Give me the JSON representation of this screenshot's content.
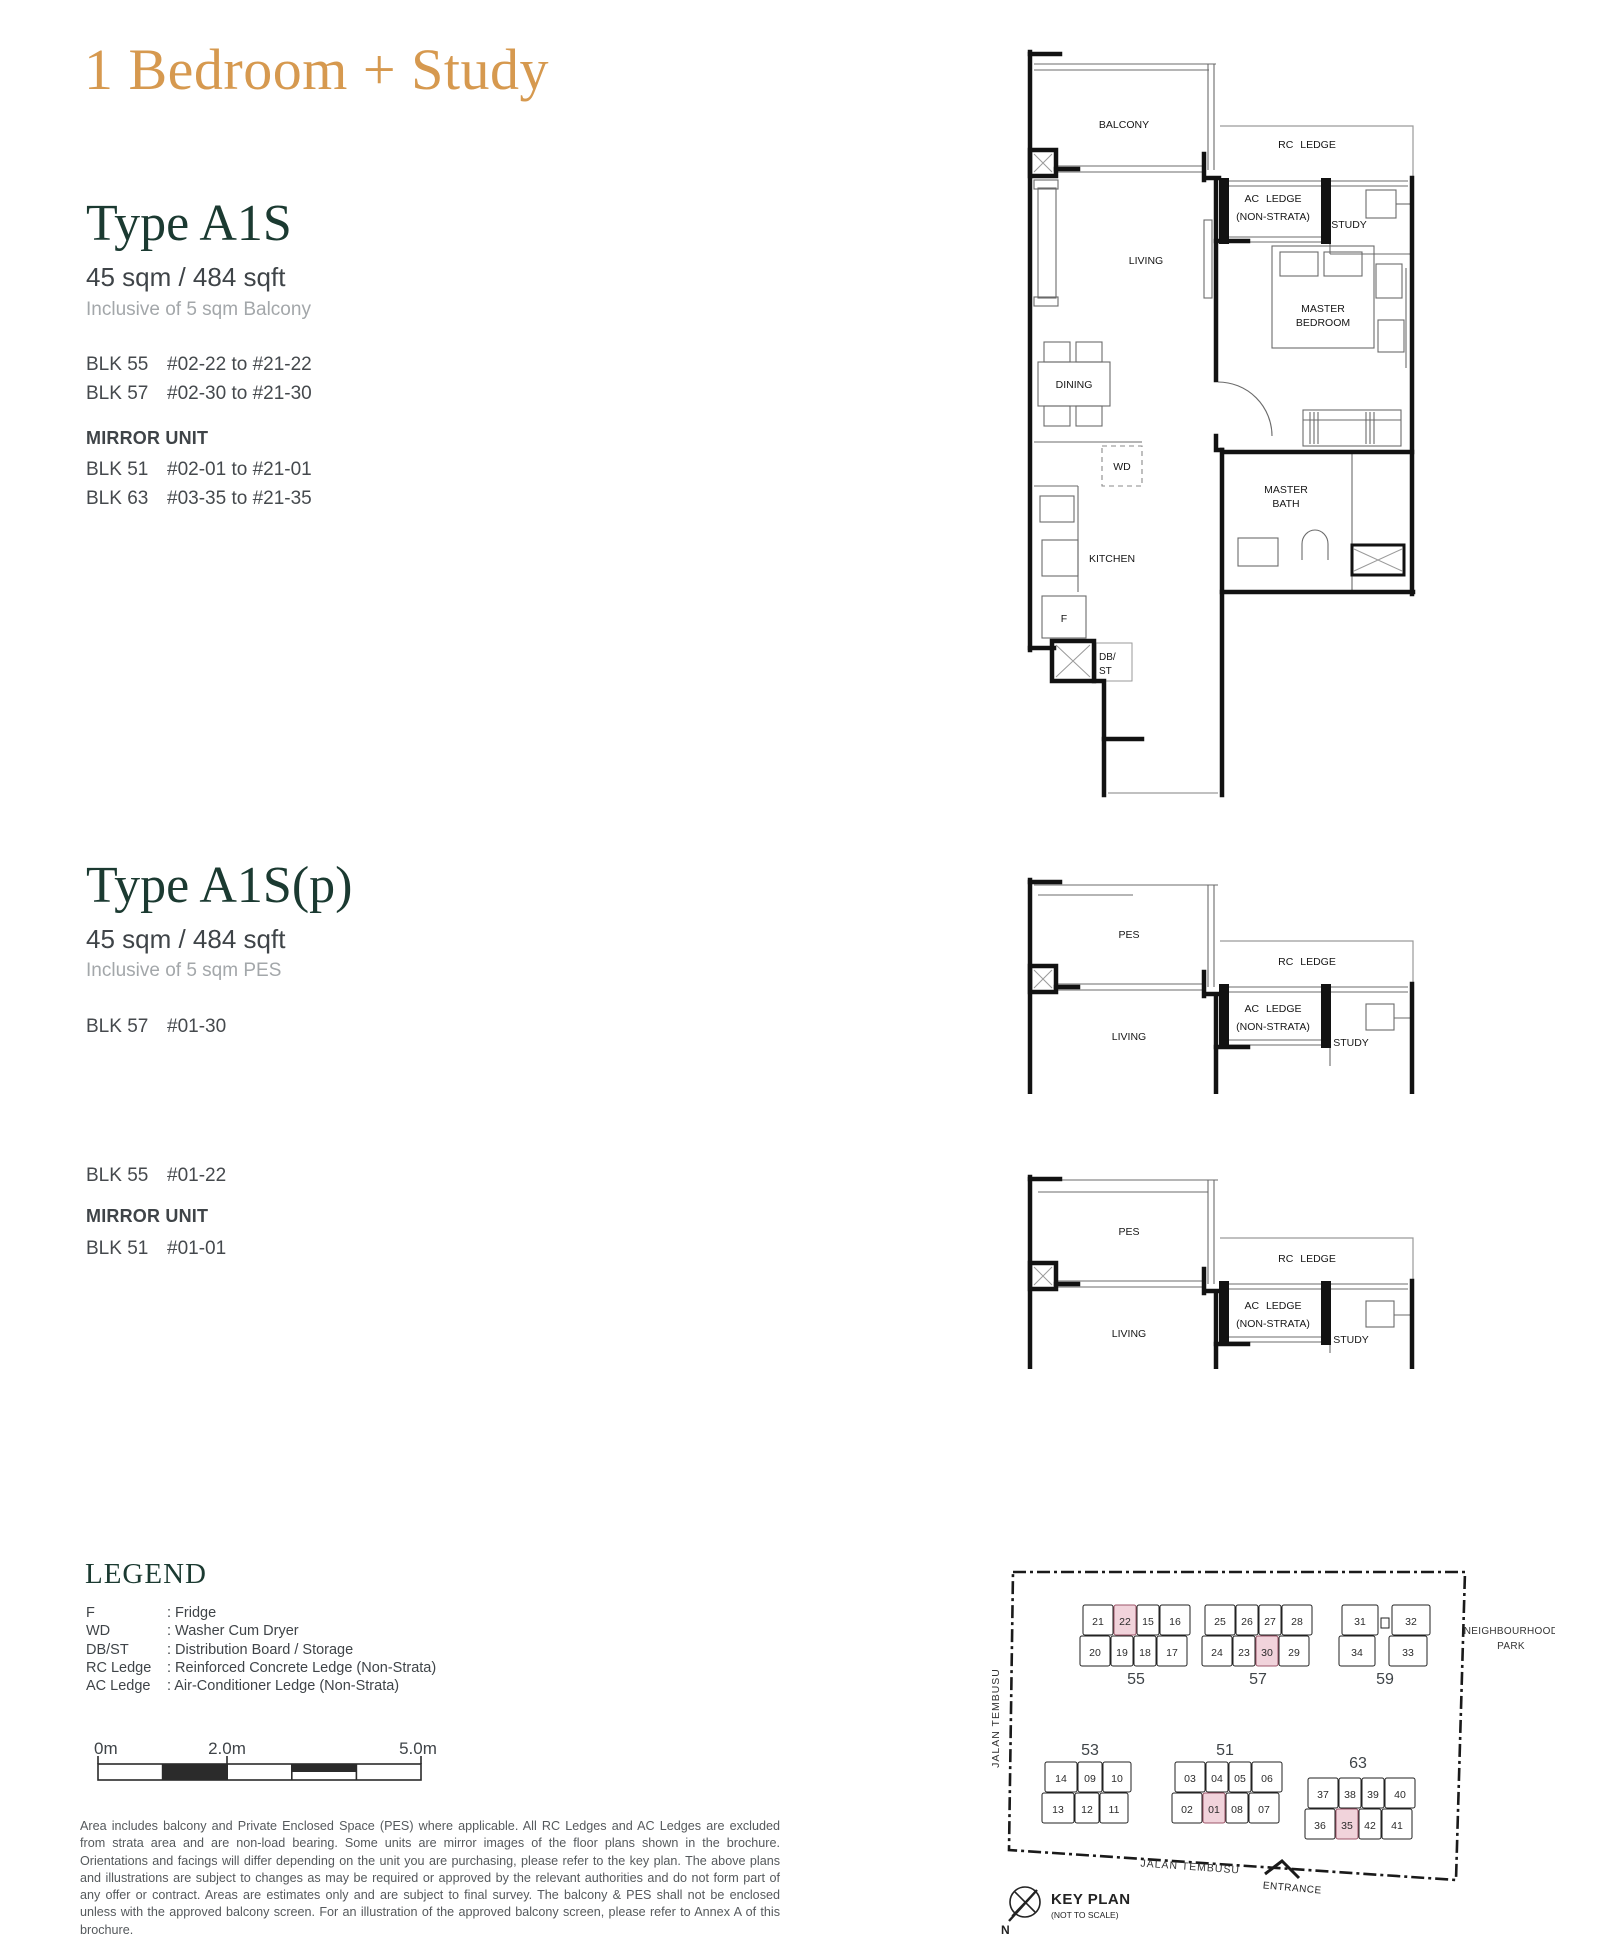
{
  "page": {
    "title": "1 Bedroom + Study",
    "accent_gold": "#D6994F",
    "accent_green": "#1B3A31",
    "highlight_pink": "#F1D3DB"
  },
  "type_a1s": {
    "name": "Type A1S",
    "area": "45 sqm / 484 sqft",
    "inclusive": "Inclusive of 5 sqm Balcony",
    "blocks": [
      {
        "blk": "BLK 55",
        "range": "#02-22 to #21-22"
      },
      {
        "blk": "BLK 57",
        "range": "#02-30 to #21-30"
      }
    ],
    "mirror_label": "MIRROR UNIT",
    "mirror_blocks": [
      {
        "blk": "BLK 51",
        "range": "#02-01 to #21-01"
      },
      {
        "blk": "BLK 63",
        "range": "#03-35 to #21-35"
      }
    ]
  },
  "type_a1sp": {
    "name": "Type A1S(p)",
    "area": "45 sqm / 484 sqft",
    "inclusive": "Inclusive of 5 sqm PES",
    "blocks": [
      {
        "blk": "BLK 57",
        "range": "#01-30"
      }
    ],
    "blocks2": [
      {
        "blk": "BLK 55",
        "range": "#01-22"
      }
    ],
    "mirror_label": "MIRROR UNIT",
    "mirror_blocks": [
      {
        "blk": "BLK 51",
        "range": "#01-01"
      }
    ]
  },
  "plan_a1s": {
    "labels": {
      "balcony": "BALCONY",
      "rc_ledge": "RC LEDGE",
      "ac_ledge_1": "AC LEDGE",
      "ac_ledge_2": "(NON-STRATA)",
      "study": "STUDY",
      "living": "LIVING",
      "master_bedroom_1": "MASTER",
      "master_bedroom_2": "BEDROOM",
      "dining": "DINING",
      "wd": "WD",
      "kitchen": "KITCHEN",
      "master_bath_1": "MASTER",
      "master_bath_2": "BATH",
      "fridge": "F",
      "dbst_1": "DB/",
      "dbst_2": "ST"
    }
  },
  "plan_a1sp_1": {
    "labels": {
      "pes": "PES",
      "rc_ledge": "RC LEDGE",
      "ac_ledge_1": "AC LEDGE",
      "ac_ledge_2": "(NON-STRATA)",
      "study": "STUDY",
      "living": "LIVING"
    }
  },
  "plan_a1sp_2": {
    "labels": {
      "pes": "PES",
      "rc_ledge": "RC LEDGE",
      "ac_ledge_1": "AC LEDGE",
      "ac_ledge_2": "(NON-STRATA)",
      "study": "STUDY",
      "living": "LIVING"
    }
  },
  "legend": {
    "title": "LEGEND",
    "items": [
      {
        "key": "F",
        "value": ": Fridge"
      },
      {
        "key": "WD",
        "value": ": Washer Cum Dryer"
      },
      {
        "key": "DB/ST",
        "value": ": Distribution Board / Storage"
      },
      {
        "key": "RC Ledge",
        "value": ": Reinforced Concrete Ledge (Non-Strata)"
      },
      {
        "key": "AC Ledge",
        "value": ": Air-Conditioner Ledge (Non-Strata)"
      }
    ]
  },
  "scalebar": {
    "label_0": "0m",
    "label_2": "2.0m",
    "label_5": "5.0m"
  },
  "disclaimer": "Area includes balcony and Private Enclosed Space (PES) where applicable. All RC Ledges and AC Ledges are excluded from strata area and are non-load bearing. Some units are mirror images of the floor plans shown in the brochure. Orientations and facings will differ depending on the unit you are purchasing, please refer to the key plan. The above plans and illustrations are subject to changes as may be required or approved by the relevant authorities and do not form part of any offer or contract. Areas are estimates only and are subject to final survey. The balcony & PES shall not be enclosed unless with the approved balcony screen. For an illustration of the approved balcony screen, please refer to Annex A of this brochure.",
  "keyplan": {
    "title": "KEY PLAN",
    "subtitle": "(NOT TO SCALE)",
    "north_label": "N",
    "road_left": "JALAN TEMBUSU",
    "road_bottom": "JALAN TEMBUSU",
    "park_1": "NEIGHBOURHOOD",
    "park_2": "PARK",
    "entrance": "ENTRANCE",
    "blocks": [
      {
        "id": "55",
        "rows": [
          [
            "21",
            "22",
            "15",
            "16"
          ],
          [
            "20",
            "19",
            "18",
            "17"
          ]
        ],
        "highlighted": [
          "22"
        ]
      },
      {
        "id": "57",
        "rows": [
          [
            "25",
            "26",
            "27",
            "28"
          ],
          [
            "24",
            "23",
            "30",
            "29"
          ]
        ],
        "highlighted": [
          "30"
        ]
      },
      {
        "id": "59",
        "rows": [
          [
            "31",
            "32"
          ],
          [
            "34",
            "33"
          ]
        ],
        "highlighted": []
      },
      {
        "id": "53",
        "rows": [
          [
            "14",
            "09",
            "10"
          ],
          [
            "13",
            "12",
            "11"
          ]
        ],
        "highlighted": []
      },
      {
        "id": "51",
        "rows": [
          [
            "03",
            "04",
            "05",
            "06"
          ],
          [
            "02",
            "01",
            "08",
            "07"
          ]
        ],
        "highlighted": [
          "01"
        ]
      },
      {
        "id": "63",
        "rows": [
          [
            "37",
            "38",
            "39",
            "40"
          ],
          [
            "36",
            "35",
            "42",
            "41"
          ]
        ],
        "highlighted": [
          "35"
        ]
      }
    ]
  }
}
